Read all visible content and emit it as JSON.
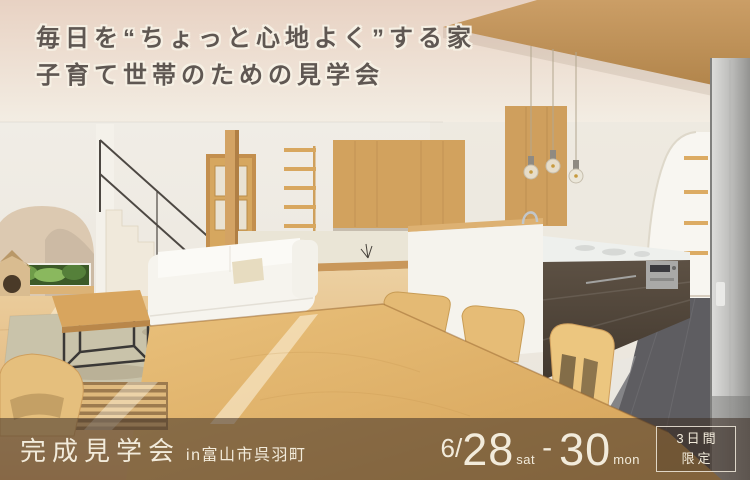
{
  "headline": {
    "line1": "毎日を“ちょっと心地よく”する家",
    "line2": "子育て世帯のための見学会"
  },
  "footer": {
    "event_title": "完成見学会",
    "location": "in富山市呉羽町",
    "date": {
      "month": "6/",
      "start_day": "28",
      "start_weekday": "sat",
      "separator": "-",
      "end_day": "30",
      "end_weekday": "mon"
    },
    "badge": {
      "line1": "3日間",
      "line2": "限定"
    }
  },
  "colors": {
    "headline_text": "#5f5752",
    "headline_outline": "#f6f0e4",
    "footer_overlay": "rgba(62,48,38,0.55)",
    "footer_text": "#f2ebdb",
    "badge_border": "rgba(243,236,222,0.85)",
    "wood_accent": "#cf9f5d",
    "floor_wood": "#e0b173",
    "cabinet_brown": "#53483c",
    "tile_gray": "#5e5d61",
    "greenery": "#6f9c49"
  },
  "scene": {
    "description": "3D interior rendering of an open-plan home: living room with white sofa, arched alcove with garden window, staircase, tatami nook with wood panel wall, light-wood dining table with chairs, island kitchen with pendant lights, dark cabinets, arched pantry shelves and refrigerator"
  }
}
